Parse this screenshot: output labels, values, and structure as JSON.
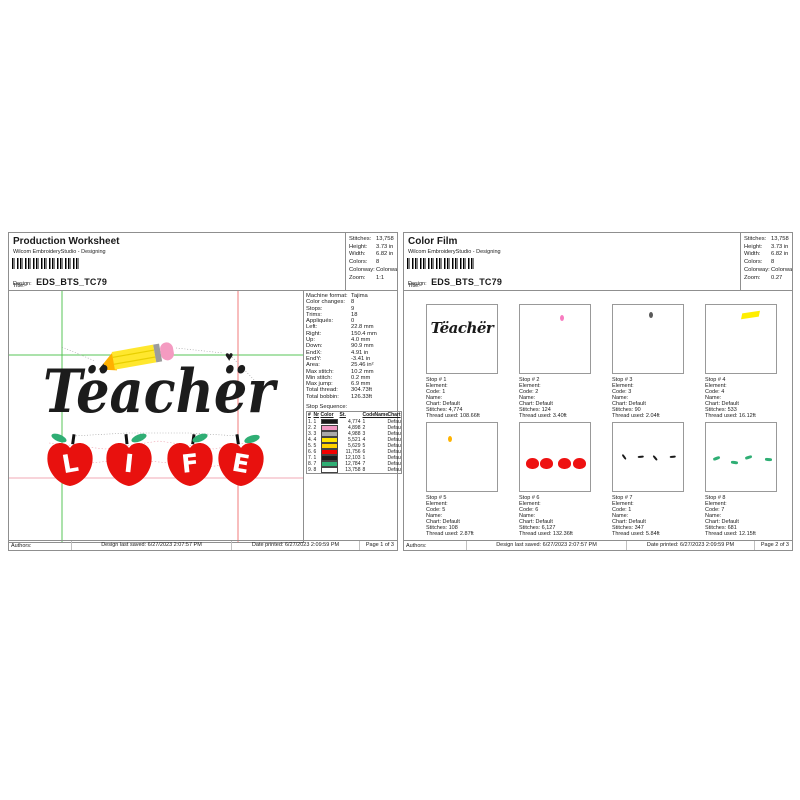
{
  "labels": {
    "design": "Design:",
    "title": "Title:"
  },
  "colors": {
    "grid_green": "#57c457",
    "grid_red": "#f07b7b",
    "grid_pink": "#f2a8b4",
    "pencil_yellow": "#ffe72e",
    "pencil_tip": "#ffb000",
    "eraser_pink": "#f49bc1",
    "ferrule_gray": "#9c9c9c",
    "apple_red": "#e8110e",
    "leaf_green": "#2fae74",
    "stitch_black": "#1c1c1c"
  },
  "page1": {
    "title": "Production Worksheet",
    "subtitle": "Wilcom EmbroideryStudio - Designing",
    "design_value": "EDS_BTS_TC79",
    "stats": [
      {
        "label": "Stitches:",
        "value": "13,758"
      },
      {
        "label": "Height:",
        "value": "3.73 in"
      },
      {
        "label": "Width:",
        "value": "6.82 in"
      },
      {
        "label": "Colors:",
        "value": "8"
      },
      {
        "label": "Colorway:",
        "value": "Colorway 1"
      },
      {
        "label": "Zoom:",
        "value": "1:1"
      }
    ],
    "machine_info": [
      [
        "Machine format:",
        "Tajima"
      ],
      [
        "Color changes:",
        "8"
      ],
      [
        "Stops:",
        "9"
      ],
      [
        "Trims:",
        "18"
      ],
      [
        "Appliqués:",
        "0"
      ],
      [
        "Left:",
        "22.8 mm"
      ],
      [
        "Right:",
        "150.4 mm"
      ],
      [
        "Up:",
        "4.0 mm"
      ],
      [
        "Down:",
        "90.9 mm"
      ],
      [
        "EndX:",
        "4.91 in"
      ],
      [
        "EndY:",
        "-3.41 in"
      ],
      [
        "Area:",
        "25.46 in²"
      ],
      [
        "Max stitch:",
        "10.2 mm"
      ],
      [
        "Min stitch:",
        "0.2 mm"
      ],
      [
        "Max jump:",
        "6.9 mm"
      ],
      [
        "Total thread:",
        "304.73ft"
      ],
      [
        "Total bobbin:",
        "126.33ft"
      ]
    ],
    "stop_sequence_label": "Stop Sequence:",
    "stop_table": {
      "headers": [
        "#",
        "Nr",
        "Color",
        "St.",
        "Code",
        "Name",
        "Chart"
      ],
      "rows": [
        {
          "n": "1.",
          "nr": "1",
          "color": "#1a1a1a",
          "st": "4,774",
          "code": "1",
          "name": "",
          "chart": "Default"
        },
        {
          "n": "2.",
          "nr": "2",
          "color": "#f398c4",
          "st": "4,898",
          "code": "2",
          "name": "",
          "chart": "Default"
        },
        {
          "n": "3.",
          "nr": "3",
          "color": "#a9a9a9",
          "st": "4,988",
          "code": "3",
          "name": "",
          "chart": "Default"
        },
        {
          "n": "4.",
          "nr": "4",
          "color": "#ffe600",
          "st": "5,521",
          "code": "4",
          "name": "",
          "chart": "Default"
        },
        {
          "n": "5.",
          "nr": "5",
          "color": "#ffd200",
          "st": "5,629",
          "code": "5",
          "name": "",
          "chart": "Default"
        },
        {
          "n": "6.",
          "nr": "6",
          "color": "#f20000",
          "st": "11,756",
          "code": "6",
          "name": "",
          "chart": "Default"
        },
        {
          "n": "7.",
          "nr": "1",
          "color": "#1a1a1a",
          "st": "12,103",
          "code": "1",
          "name": "",
          "chart": "Default"
        },
        {
          "n": "8.",
          "nr": "7",
          "color": "#2fae74",
          "st": "12,784",
          "code": "7",
          "name": "",
          "chart": "Default"
        },
        {
          "n": "9.",
          "nr": "8",
          "color": "#ffffff",
          "st": "13,758",
          "code": "8",
          "name": "",
          "chart": "Default"
        }
      ]
    },
    "design": {
      "word": "Tëachër",
      "letters": [
        "L",
        "I",
        "F",
        "E"
      ]
    },
    "footer": {
      "authors": "Authors:",
      "saved": "Design last saved: 6/27/2023 2:07:57 PM",
      "printed": "Date printed: 6/27/2023 2:09:59 PM",
      "page": "Page 1 of 3"
    }
  },
  "page2": {
    "title": "Color Film",
    "subtitle": "Wilcom EmbroideryStudio - Designing",
    "design_value": "EDS_BTS_TC79",
    "stats": [
      {
        "label": "Stitches:",
        "value": "13,758"
      },
      {
        "label": "Height:",
        "value": "3.73 in"
      },
      {
        "label": "Width:",
        "value": "6.82 in"
      },
      {
        "label": "Colors:",
        "value": "8"
      },
      {
        "label": "Colorway:",
        "value": "Colorway 1"
      },
      {
        "label": "Zoom:",
        "value": "0.27"
      }
    ],
    "cells": [
      {
        "thumb": {
          "type": "text",
          "color": "#1a1a1a"
        },
        "lines": [
          "Stop # 1",
          "Element:",
          "Code: 1",
          "Name:",
          "Chart: Default",
          "Stitches: 4,774",
          "Thread used: 108.66ft"
        ]
      },
      {
        "thumb": {
          "type": "dot",
          "color": "#f87cc0",
          "x": 57,
          "y": 15
        },
        "lines": [
          "Stop # 2",
          "Element:",
          "Code: 2",
          "Name:",
          "Chart: Default",
          "Stitches: 124",
          "Thread used: 3.40ft"
        ]
      },
      {
        "thumb": {
          "type": "dot",
          "color": "#5a5a5a",
          "x": 52,
          "y": 11
        },
        "lines": [
          "Stop # 3",
          "Element:",
          "Code: 3",
          "Name:",
          "Chart: Default",
          "Stitches: 90",
          "Thread used: 2.04ft"
        ]
      },
      {
        "thumb": {
          "type": "bar",
          "color": "#ffee00",
          "x": 52,
          "y": 11
        },
        "lines": [
          "Stop # 4",
          "Element:",
          "Code: 4",
          "Name:",
          "Chart: Default",
          "Stitches: 533",
          "Thread used: 16.12ft"
        ]
      },
      {
        "thumb": {
          "type": "dot",
          "color": "#ffb300",
          "x": 30,
          "y": 19
        },
        "lines": [
          "Stop # 5",
          "Element:",
          "Code: 5",
          "Name:",
          "Chart: Default",
          "Stitches: 108",
          "Thread used: 2.87ft"
        ]
      },
      {
        "thumb": {
          "type": "apples",
          "color": "#ee1111"
        },
        "lines": [
          "Stop # 6",
          "Element:",
          "Code: 6",
          "Name:",
          "Chart: Default",
          "Stitches: 6,127",
          "Thread used: 132.36ft"
        ]
      },
      {
        "thumb": {
          "type": "stems",
          "color": "#1a1a1a"
        },
        "lines": [
          "Stop # 7",
          "Element:",
          "Code: 1",
          "Name:",
          "Chart: Default",
          "Stitches: 347",
          "Thread used: 5.84ft"
        ]
      },
      {
        "thumb": {
          "type": "leaves",
          "color": "#2fae74"
        },
        "lines": [
          "Stop # 8",
          "Element:",
          "Code: 7",
          "Name:",
          "Chart: Default",
          "Stitches: 681",
          "Thread used: 12.15ft"
        ]
      }
    ],
    "footer": {
      "authors": "Authors:",
      "saved": "Design last saved: 6/27/2023 2:07:57 PM",
      "printed": "Date printed: 6/27/2023 2:09:59 PM",
      "page": "Page 2 of 3"
    }
  }
}
